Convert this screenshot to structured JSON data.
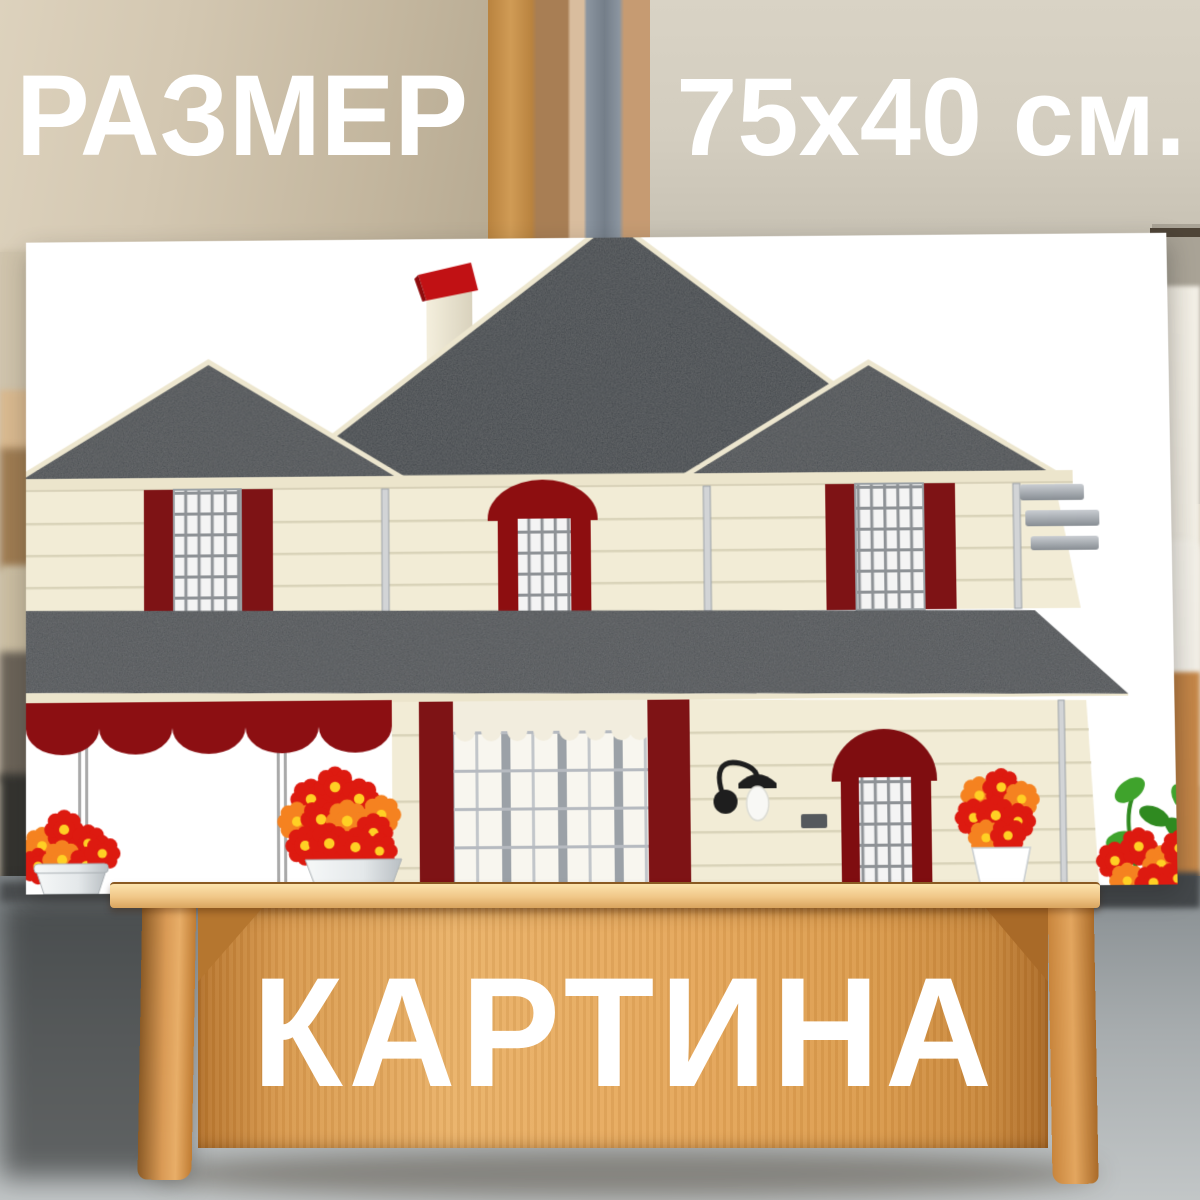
{
  "header": {
    "size_label": "РАЗМЕР",
    "size_value": "75x40 см."
  },
  "footer": {
    "product_type_label": "КАРТИНА"
  },
  "colors": {
    "text_white": "#ffffff",
    "bg_wall_left": "#cdbfa6",
    "bg_wall_right": "#d9d3c5",
    "curtain": "#ece7dc",
    "chair": "#b5773c",
    "sky": "#ffffff",
    "roof_dark": "#3e4246",
    "roof_mid": "#474b4f",
    "porch_roof": "#4b4f53",
    "trim_cream": "#ece5cc",
    "wall_cream": "#f2ecd6",
    "siding": "#d9d3b9",
    "maroon": "#7e1315",
    "door_red": "#7f0d10",
    "awning_red": "#8c0f12",
    "chimney_cap": "#c11114",
    "chimney_body": "#ece6d2",
    "pane": "#f4f4f4",
    "grid": "#8e9296",
    "plaid_bg": "#f8f6ef",
    "valance": "#f2edde",
    "flower_red": "#dd1a10",
    "flower_orange": "#f58220",
    "flower_center": "#ffd024",
    "leaf": "#3fa32c",
    "leaf_dark": "#2f8a20",
    "lamp": "#1e1e1e",
    "gutter": "#b7bcc1",
    "tray_light": "#eab268",
    "lip_light": "#fce3ad"
  }
}
